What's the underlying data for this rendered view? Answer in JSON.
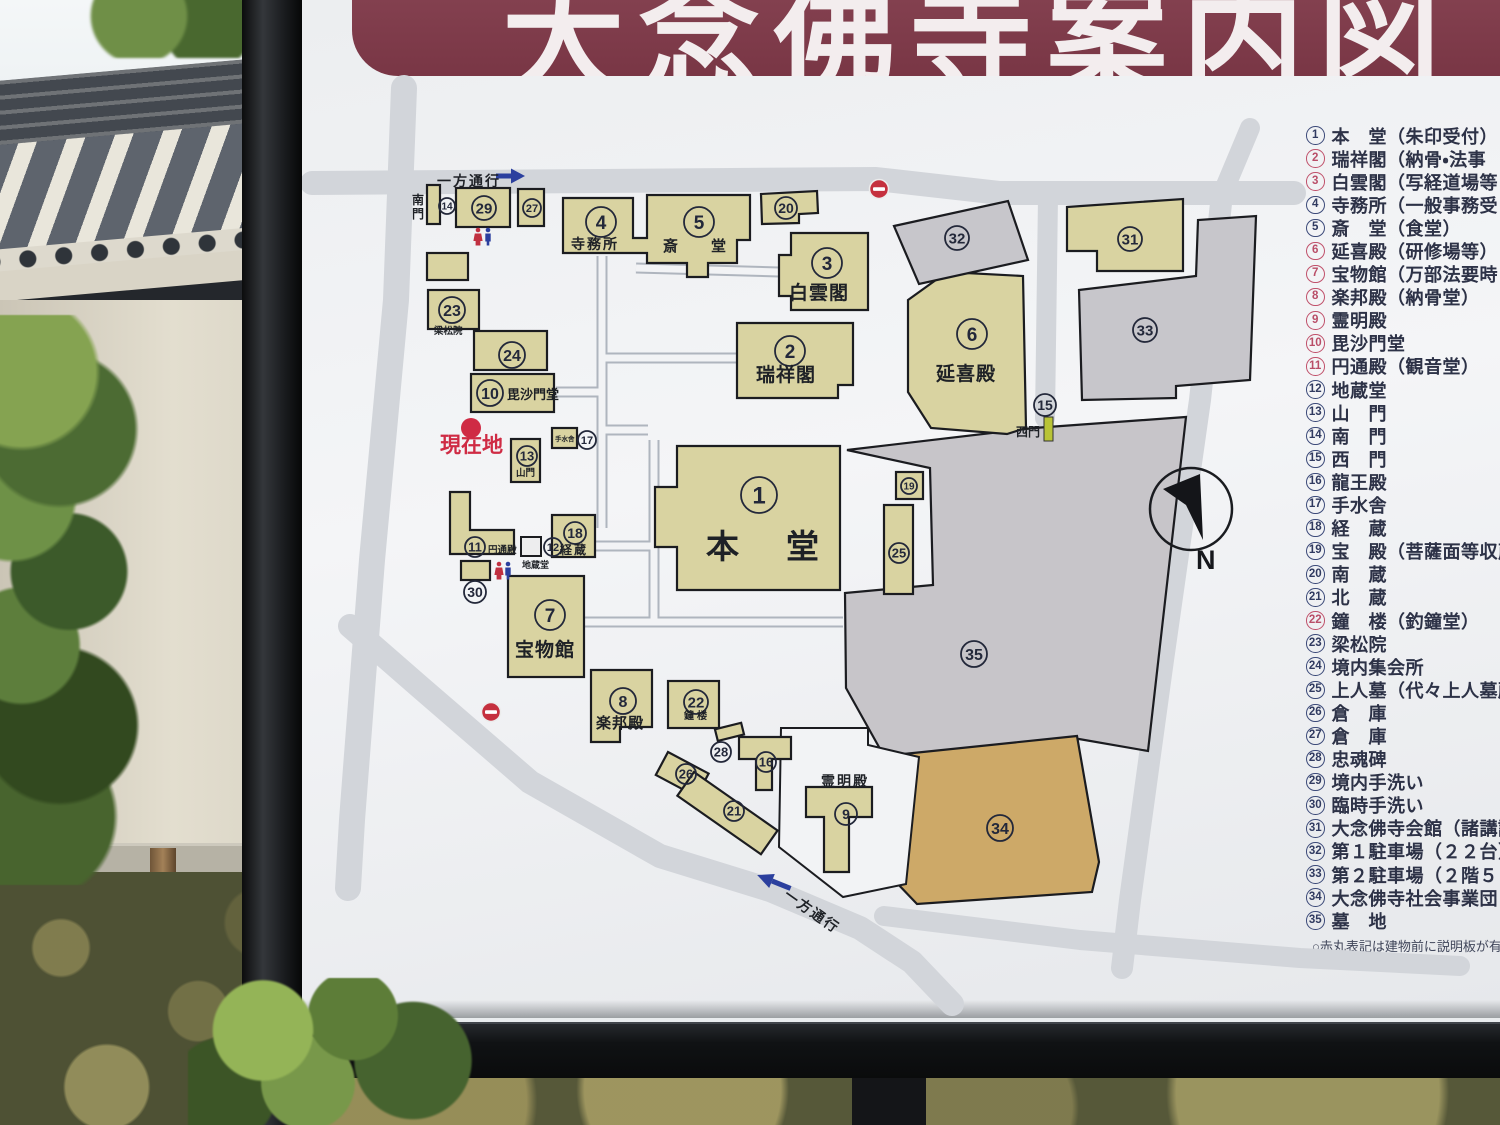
{
  "sign": {
    "title": "大念佛寺案内図",
    "footnote": "○赤丸表記は建物前に説明板が有り",
    "compass_label": "N"
  },
  "legend": {
    "items": [
      {
        "n": "1",
        "text": "本　堂（朱印受付）",
        "red": false
      },
      {
        "n": "2",
        "text": "瑞祥閣（納骨・法事",
        "red": true
      },
      {
        "n": "3",
        "text": "白雲閣（写経道場等",
        "red": true
      },
      {
        "n": "4",
        "text": "寺務所（一般事務受",
        "red": false
      },
      {
        "n": "5",
        "text": "斎　堂（食堂）",
        "red": false
      },
      {
        "n": "6",
        "text": "延喜殿（研修場等）",
        "red": true
      },
      {
        "n": "7",
        "text": "宝物館（万部法要時",
        "red": true
      },
      {
        "n": "8",
        "text": "楽邦殿（納骨堂）",
        "red": true
      },
      {
        "n": "9",
        "text": "霊明殿",
        "red": true
      },
      {
        "n": "10",
        "text": "毘沙門堂",
        "red": true
      },
      {
        "n": "11",
        "text": "円通殿（観音堂）",
        "red": true
      },
      {
        "n": "12",
        "text": "地蔵堂",
        "red": false
      },
      {
        "n": "13",
        "text": "山　門",
        "red": false
      },
      {
        "n": "14",
        "text": "南　門",
        "red": false
      },
      {
        "n": "15",
        "text": "西　門",
        "red": false
      },
      {
        "n": "16",
        "text": "龍王殿",
        "red": false
      },
      {
        "n": "17",
        "text": "手水舎",
        "red": false
      },
      {
        "n": "18",
        "text": "経　蔵",
        "red": false
      },
      {
        "n": "19",
        "text": "宝　殿（菩薩面等収蔵",
        "red": false
      },
      {
        "n": "20",
        "text": "南　蔵",
        "red": false
      },
      {
        "n": "21",
        "text": "北　蔵",
        "red": false
      },
      {
        "n": "22",
        "text": "鐘　楼（釣鐘堂）",
        "red": true
      },
      {
        "n": "23",
        "text": "梁松院",
        "red": false
      },
      {
        "n": "24",
        "text": "境内集会所",
        "red": false
      },
      {
        "n": "25",
        "text": "上人墓（代々上人墓所",
        "red": false
      },
      {
        "n": "26",
        "text": "倉　庫",
        "red": false
      },
      {
        "n": "27",
        "text": "倉　庫",
        "red": false
      },
      {
        "n": "28",
        "text": "忠魂碑",
        "red": false
      },
      {
        "n": "29",
        "text": "境内手洗い",
        "red": false
      },
      {
        "n": "30",
        "text": "臨時手洗い",
        "red": false
      },
      {
        "n": "31",
        "text": "大念佛寺会館（諸講詰",
        "red": false
      },
      {
        "n": "32",
        "text": "第１駐車場（２２台）",
        "red": false
      },
      {
        "n": "33",
        "text": "第２駐車場（２階５８台）",
        "red": false
      },
      {
        "n": "34",
        "text": "大念佛寺社会事業団",
        "red": false
      },
      {
        "n": "35",
        "text": "墓　地",
        "red": false
      }
    ]
  },
  "map": {
    "markers": [
      {
        "n": "14",
        "x": 447,
        "y": 206,
        "r": 8
      },
      {
        "n": "29",
        "x": 484,
        "y": 208,
        "r": 12
      },
      {
        "n": "27",
        "x": 532,
        "y": 208,
        "r": 9
      },
      {
        "n": "23",
        "x": 452,
        "y": 310,
        "r": 13
      },
      {
        "n": "24",
        "x": 512,
        "y": 355,
        "r": 13
      },
      {
        "n": "10",
        "x": 490,
        "y": 393,
        "r": 13
      },
      {
        "n": "13",
        "x": 527,
        "y": 456,
        "r": 10
      },
      {
        "n": "17",
        "x": 587,
        "y": 440,
        "r": 9
      },
      {
        "n": "11",
        "x": 475,
        "y": 547,
        "r": 10
      },
      {
        "n": "12",
        "x": 553,
        "y": 547,
        "r": 9
      },
      {
        "n": "18",
        "x": 575,
        "y": 533,
        "r": 11
      },
      {
        "n": "30",
        "x": 475,
        "y": 592,
        "r": 11
      },
      {
        "n": "7",
        "x": 550,
        "y": 615,
        "r": 15
      },
      {
        "n": "8",
        "x": 623,
        "y": 701,
        "r": 13
      },
      {
        "n": "22",
        "x": 696,
        "y": 702,
        "r": 12
      },
      {
        "n": "28",
        "x": 721,
        "y": 752,
        "r": 10
      },
      {
        "n": "16",
        "x": 766,
        "y": 762,
        "r": 10
      },
      {
        "n": "26",
        "x": 686,
        "y": 774,
        "r": 10
      },
      {
        "n": "21",
        "x": 734,
        "y": 811,
        "r": 10
      },
      {
        "n": "9",
        "x": 846,
        "y": 814,
        "r": 11
      },
      {
        "n": "34",
        "x": 1000,
        "y": 828,
        "r": 13
      },
      {
        "n": "35",
        "x": 974,
        "y": 654,
        "r": 13
      },
      {
        "n": "1",
        "x": 759,
        "y": 495,
        "r": 18,
        "fs": 24
      },
      {
        "n": "19",
        "x": 909,
        "y": 486,
        "r": 8
      },
      {
        "n": "25",
        "x": 899,
        "y": 553,
        "r": 10
      },
      {
        "n": "2",
        "x": 790,
        "y": 351,
        "r": 15,
        "fs": 19
      },
      {
        "n": "3",
        "x": 827,
        "y": 263,
        "r": 15,
        "fs": 19
      },
      {
        "n": "6",
        "x": 972,
        "y": 334,
        "r": 15,
        "fs": 19
      },
      {
        "n": "32",
        "x": 957,
        "y": 238,
        "r": 12
      },
      {
        "n": "31",
        "x": 1130,
        "y": 239,
        "r": 12
      },
      {
        "n": "33",
        "x": 1145,
        "y": 330,
        "r": 12
      },
      {
        "n": "20",
        "x": 786,
        "y": 208,
        "r": 11
      },
      {
        "n": "5",
        "x": 699,
        "y": 222,
        "r": 15,
        "fs": 19
      },
      {
        "n": "4",
        "x": 601,
        "y": 222,
        "r": 15,
        "fs": 19
      },
      {
        "n": "15",
        "x": 1045,
        "y": 405,
        "r": 11
      }
    ],
    "labels": [
      {
        "t": "寺務所",
        "x": 571,
        "y": 249,
        "s": 14,
        "ls": 2
      },
      {
        "t": "斎　堂",
        "x": 663,
        "y": 251,
        "s": 15,
        "ls": 9
      },
      {
        "t": "白雲閣",
        "x": 789,
        "y": 299,
        "s": 19,
        "ls": 1
      },
      {
        "t": "瑞祥閣",
        "x": 756,
        "y": 381,
        "s": 19,
        "ls": 1
      },
      {
        "t": "延喜殿",
        "x": 936,
        "y": 380,
        "s": 19,
        "ls": 1
      },
      {
        "t": "本　堂",
        "x": 706,
        "y": 558,
        "s": 33,
        "ls": 7
      },
      {
        "t": "宝物館",
        "x": 515,
        "y": 656,
        "s": 19,
        "ls": 1
      },
      {
        "t": "楽邦殿",
        "x": 596,
        "y": 728,
        "s": 15,
        "ls": 1
      },
      {
        "t": "毘沙門堂",
        "x": 507,
        "y": 399,
        "s": 13
      },
      {
        "t": "経蔵",
        "x": 560,
        "y": 554,
        "s": 12,
        "ls": 2
      },
      {
        "t": "梁松院",
        "x": 434,
        "y": 334,
        "s": 9.5
      },
      {
        "t": "山門",
        "x": 516,
        "y": 476,
        "s": 9.5
      },
      {
        "t": "地蔵堂",
        "x": 522,
        "y": 568,
        "s": 9
      },
      {
        "t": "円通殿",
        "x": 488,
        "y": 553,
        "s": 9.5
      },
      {
        "t": "手水舎",
        "x": 555,
        "y": 441,
        "s": 6.5
      },
      {
        "t": "鐘楼",
        "x": 684,
        "y": 719,
        "s": 10,
        "ls": 3
      },
      {
        "t": "霊明殿",
        "x": 821,
        "y": 786,
        "s": 14,
        "ls": 2
      },
      {
        "t": "西門",
        "x": 1016,
        "y": 436,
        "s": 12
      },
      {
        "t": "南門",
        "x": 412,
        "y": 204,
        "s": 12,
        "vert": true
      },
      {
        "t": "現在地",
        "x": 440,
        "y": 452,
        "s": 21,
        "c": "#cf2b44",
        "w": 700
      },
      {
        "t": "一方通行",
        "x": 437,
        "y": 186,
        "s": 14,
        "ls": 2
      },
      {
        "t": "一方通行",
        "x": 783,
        "y": 897,
        "s": 14,
        "ls": 2,
        "rot": 35
      }
    ]
  },
  "colors": {
    "title_band": "#7c3a49",
    "building_tan": "#d9d3a1",
    "parking_gray": "#c7c6cb",
    "cemetery_gray": "#c7c5c9",
    "works_area_tan": "#cda968",
    "road_gray": "#d2d5da",
    "legend_navy": "#3c4a79",
    "legend_red": "#c0516b",
    "current_location_red": "#cf2b44",
    "oneway_blue": "#2b3f9e",
    "west_gate_green": "#b9c437"
  }
}
